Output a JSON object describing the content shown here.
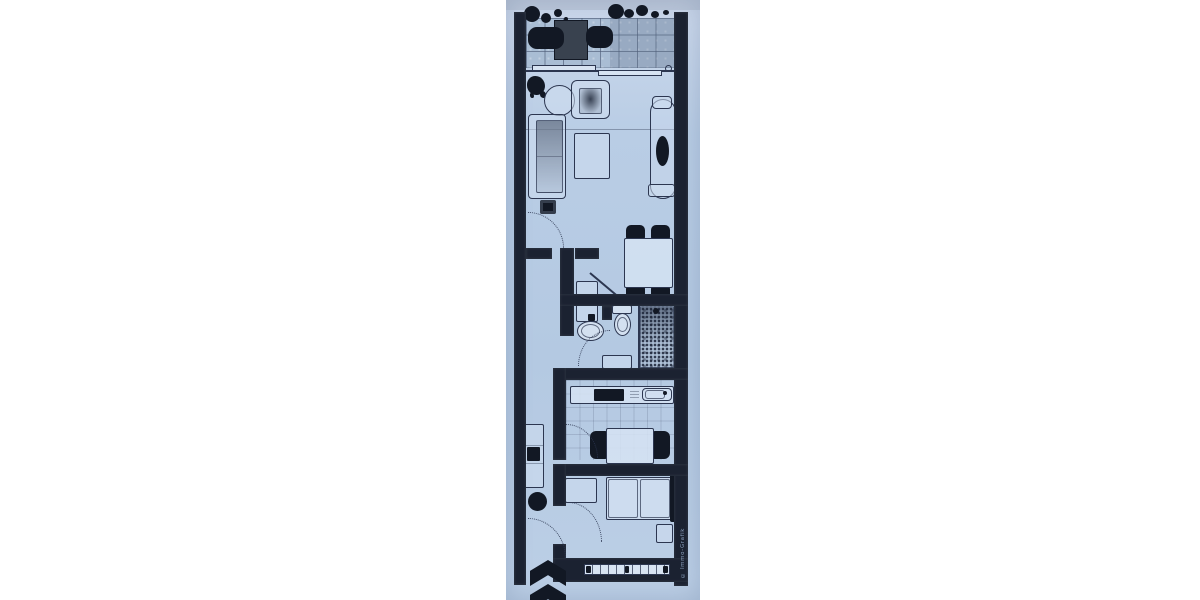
{
  "colors": {
    "canvas_background": "#ffffff",
    "paper_light": "#cdd9ec",
    "paper_mid": "#b9cde5",
    "wall": "#1b2231",
    "line": "#2c3650",
    "furniture_dark": "#121824",
    "tile_base": "#a9bdd4"
  },
  "watermark": {
    "text": "© Immo-Grafik"
  },
  "floorplan": {
    "description": "scanned blue-tinted floor plan of a narrow one-bedroom apartment, no text labels",
    "rooms": [
      {
        "name": "balcony",
        "contents": [
          "tiled-floor",
          "two-loungers",
          "side-table",
          "planter-boxes",
          "sliding-door"
        ]
      },
      {
        "name": "living-room",
        "contents": [
          "sofa",
          "armchair",
          "round-side-table",
          "coffee-table",
          "lounge-chair",
          "plant",
          "stool"
        ]
      },
      {
        "name": "dining-area",
        "contents": [
          "dining-table",
          "four-chairs"
        ]
      },
      {
        "name": "hallway",
        "contents": [
          "wardrobe",
          "shelf-unit",
          "plant"
        ]
      },
      {
        "name": "bathroom",
        "contents": [
          "washbasin",
          "toilet",
          "shower",
          "shelf"
        ]
      },
      {
        "name": "kitchen",
        "contents": [
          "counter",
          "cooktop",
          "sink",
          "table",
          "two-chairs",
          "tiled-floor"
        ]
      },
      {
        "name": "bedroom",
        "contents": [
          "double-bed",
          "wardrobe",
          "nightstand",
          "window"
        ]
      }
    ],
    "symbols": [
      "north-arrow",
      "dotted-door-swing-arcs",
      "window-hatch-strip"
    ]
  }
}
